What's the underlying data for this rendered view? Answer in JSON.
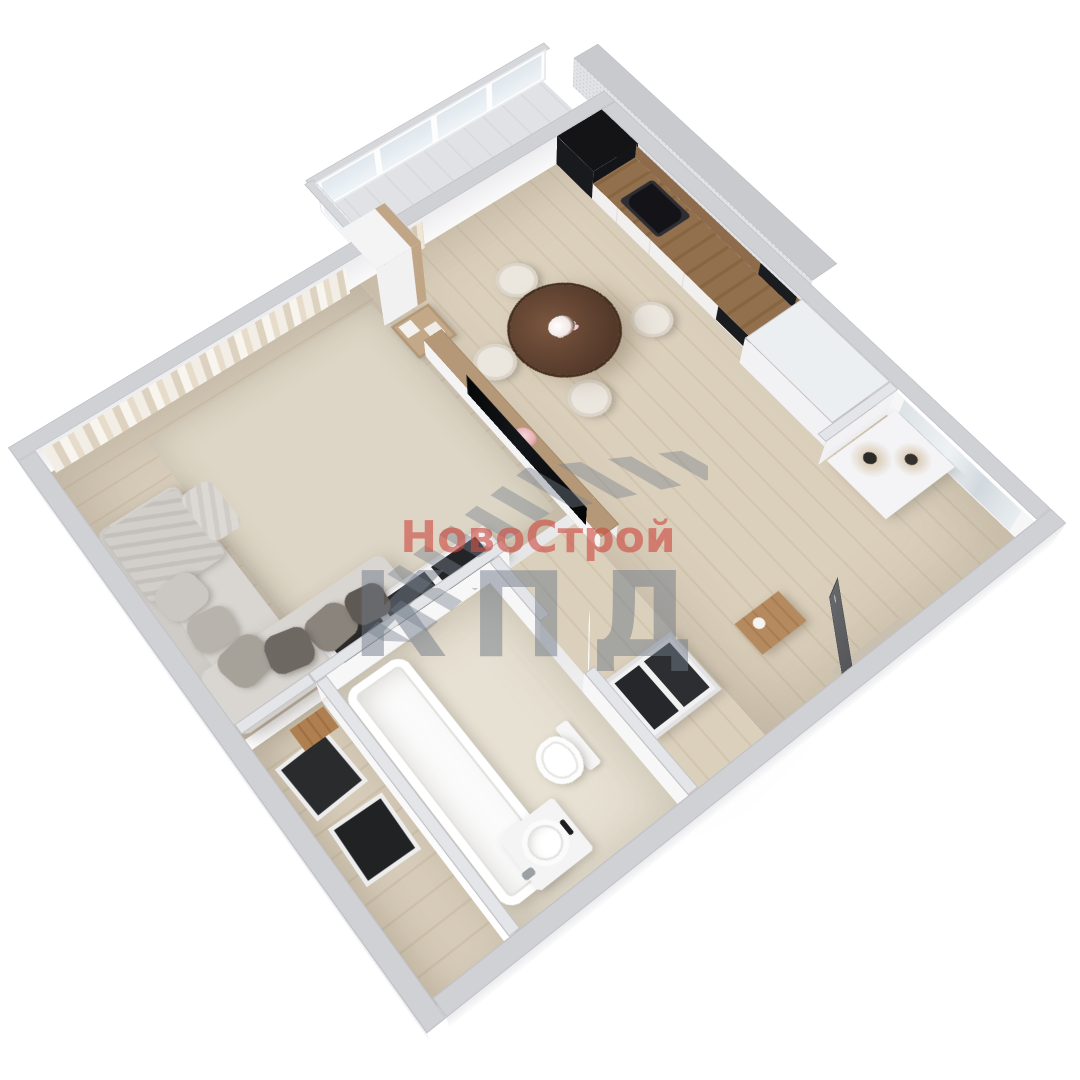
{
  "watermark": {
    "brand_top": "НовоСтрой",
    "brand_bottom": "КПД",
    "red": "#cd4b42",
    "gray": "#78808c"
  },
  "scene": {
    "type": "3d-floor-plan-render",
    "style": "white walls, light oak floors, beige textiles, isometric cutaway",
    "rooms": [
      {
        "name": "living-room",
        "items": [
          "corner-sofa",
          "throw-blanket",
          "pillows",
          "area-rug",
          "sheer-curtains",
          "tv-half-wall",
          "tv",
          "tall-cabinet",
          "open-shelf",
          "storage-sideboard"
        ]
      },
      {
        "name": "kitchen-dining",
        "items": [
          "kitchen-cabinet-run",
          "wood-backsplash",
          "oven-column",
          "cooktop",
          "built-in-oven",
          "round-dining-table",
          "dining-chairs",
          "flower-vase",
          "balcony-curtain"
        ]
      },
      {
        "name": "balcony",
        "items": [
          "glazing-panels"
        ]
      },
      {
        "name": "bathroom",
        "items": [
          "bathtub",
          "vessel-sink",
          "toilet",
          "bathroom-door"
        ]
      },
      {
        "name": "hallway",
        "items": [
          "entry-door",
          "shoe-console",
          "open-shelving",
          "decor-ledge",
          "dried-plants",
          "mirror-panel"
        ]
      },
      {
        "name": "storage-nook",
        "items": [
          "open-boxes",
          "wood-crate"
        ]
      }
    ],
    "palette": {
      "wall_top": "#d0d1d5",
      "wall_face": "#f6f6f7",
      "wood_floor": "#d7cdbb",
      "tile_floor": "#e6e0d2",
      "rug": "#ddd5c5",
      "sofa": "#d9d6d2",
      "table_wood": "#5a3e2e",
      "backsplash": "#8d6b4b",
      "appliance": "#17181a",
      "entry_door": "#55575a"
    }
  }
}
